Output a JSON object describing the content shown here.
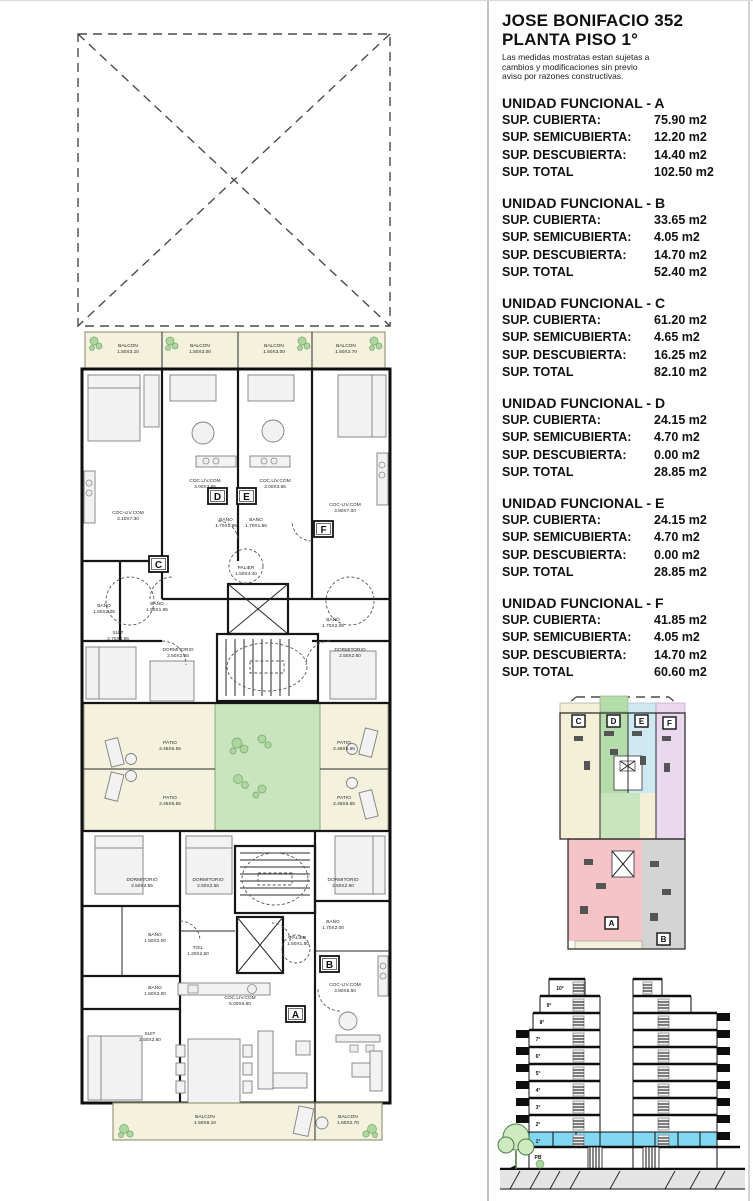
{
  "panel": {
    "title_line1": "JOSE BONIFACIO 352",
    "title_line2": "PLANTA PISO 1°",
    "disclaimer": "Las medidas mostratas estan sujetas a cambios y modificaciones sin previo aviso por razones constructivas.",
    "row_labels": {
      "cubierta": "SUP. CUBIERTA:",
      "semicubierta": "SUP. SEMICUBIERTA:",
      "descubierta": "SUP. DESCUBIERTA:",
      "total": "SUP. TOTAL"
    },
    "units": [
      {
        "title": "UNIDAD FUNCIONAL - A",
        "cubierta": "75.90 m2",
        "semicubierta": "12.20 m2",
        "descubierta": "14.40 m2",
        "total": "102.50 m2"
      },
      {
        "title": "UNIDAD FUNCIONAL - B",
        "cubierta": "33.65 m2",
        "semicubierta": "4.05 m2",
        "descubierta": "14.70 m2",
        "total": "52.40 m2"
      },
      {
        "title": "UNIDAD FUNCIONAL - C",
        "cubierta": "61.20 m2",
        "semicubierta": "4.65 m2",
        "descubierta": "16.25 m2",
        "total": "82.10 m2"
      },
      {
        "title": "UNIDAD FUNCIONAL - D",
        "cubierta": "24.15 m2",
        "semicubierta": "4.70 m2",
        "descubierta": "0.00 m2",
        "total": "28.85 m2"
      },
      {
        "title": "UNIDAD FUNCIONAL - E",
        "cubierta": "24.15 m2",
        "semicubierta": "4.70 m2",
        "descubierta": "0.00 m2",
        "total": "28.85 m2"
      },
      {
        "title": "UNIDAD FUNCIONAL - F",
        "cubierta": "41.85 m2",
        "semicubierta": "4.05 m2",
        "descubierta": "14.70 m2",
        "total": "60.60 m2"
      }
    ]
  },
  "plan": {
    "unit_letters": {
      "a": "A",
      "b": "B",
      "c": "C",
      "d": "D",
      "e": "E",
      "f": "F"
    },
    "balconies": [
      {
        "name": "BALCON",
        "dim": "1.50X3.10"
      },
      {
        "name": "BALCON",
        "dim": "1.50X3.00"
      },
      {
        "name": "BALCON",
        "dim": "1.50X3.00"
      },
      {
        "name": "BALCON",
        "dim": "1.50X2.70"
      },
      {
        "name": "BALCON",
        "dim": "1.50X8.10"
      },
      {
        "name": "BALCON",
        "dim": "1.50X2.70"
      }
    ],
    "patios": [
      {
        "name": "PATIO",
        "dim": "2.45X5.55"
      },
      {
        "name": "PATIO",
        "dim": "2.45X5.65"
      },
      {
        "name": "PATIO",
        "dim": "2.45X5.55"
      },
      {
        "name": "PATIO",
        "dim": "2.45X5.65"
      }
    ],
    "rooms": [
      {
        "name": "COC.LIV.COM",
        "dim": "3.00X3.65"
      },
      {
        "name": "COC.LIV.COM",
        "dim": "3.00X3.65"
      },
      {
        "name": "COC-LIV.COM",
        "dim": "3.10X7.30"
      },
      {
        "name": "COC-LIV.COM",
        "dim": "3.80X7.00"
      },
      {
        "name": "BAÑO",
        "dim": "1.70X1.85"
      },
      {
        "name": "BAÑO",
        "dim": "1.70X1.55"
      },
      {
        "name": "PALIER",
        "dim": "1.50X4.40"
      },
      {
        "name": "BAÑO",
        "dim": "1.50X2.05"
      },
      {
        "name": "BAÑO",
        "dim": "1.50X1.85"
      },
      {
        "name": "SUIT",
        "dim": "2.70X4.55"
      },
      {
        "name": "DORMITORIO",
        "dim": "2.50X2.55"
      },
      {
        "name": "BAÑO",
        "dim": "1.70X2.05"
      },
      {
        "name": "DORMITORIO",
        "dim": "2.50X2.50"
      },
      {
        "name": "DORMITORIO",
        "dim": "2.50X2.55"
      },
      {
        "name": "DORMITORIO",
        "dim": "2.50X2.55"
      },
      {
        "name": "DORMITORIO",
        "dim": "2.50X2.80"
      },
      {
        "name": "BAÑO",
        "dim": "1.50X2.00"
      },
      {
        "name": "TOIL",
        "dim": "1.20X2.50"
      },
      {
        "name": "PALIER",
        "dim": "1.50X1.80"
      },
      {
        "name": "BAÑO",
        "dim": "1.70X2.00"
      },
      {
        "name": "BAÑO",
        "dim": "1.50X2.00"
      },
      {
        "name": "COC.LIV.COM",
        "dim": "5.00X5.80"
      },
      {
        "name": "COC-LIV.COM",
        "dim": "3.80X5.50"
      },
      {
        "name": "SUIT",
        "dim": "2.50X2.80"
      }
    ]
  },
  "keyplan": {
    "letters": {
      "a": "A",
      "b": "B",
      "c": "C",
      "d": "D",
      "e": "E",
      "f": "F"
    }
  },
  "section": {
    "floors": [
      "10°",
      "9°",
      "8°",
      "7°",
      "6°",
      "5°",
      "4°",
      "3°",
      "2°",
      "1°",
      "PB"
    ]
  },
  "colors": {
    "balcony_cream": "#f4f1dd",
    "patio_green": "#c9e5bd",
    "unit_a_pink": "#f6c3c8",
    "unit_b_gray": "#d4d4d4",
    "unit_c_cream": "#f4f0d8",
    "unit_d_green": "#b5dcab",
    "unit_e_blue": "#cfe9f2",
    "unit_f_lavender": "#ead9ee",
    "section_floor1_highlight": "#82d7f2"
  }
}
